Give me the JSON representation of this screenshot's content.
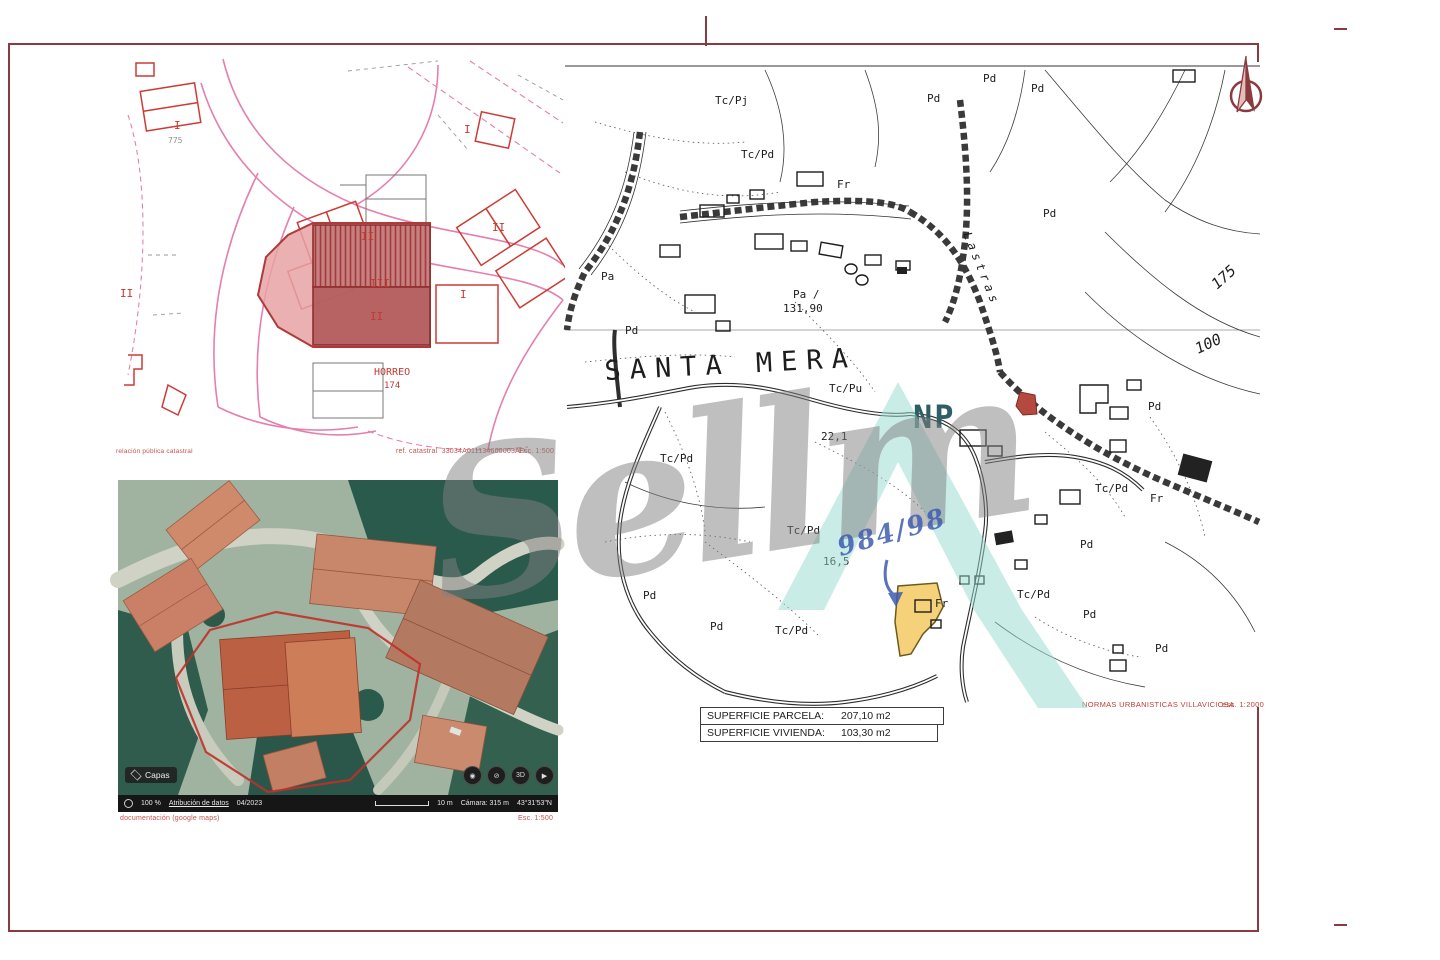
{
  "frame_color": "#8a3b42",
  "watermark": {
    "script_text": "Sellm"
  },
  "cadastral": {
    "caption_left": "relación pública catastral",
    "ref_label": "ref. catastral",
    "ref_value": "33034A011134600003AD",
    "scale": "Esc. 1:500",
    "labels": [
      {
        "t": "I",
        "x": 66,
        "y": 74
      },
      {
        "t": "775",
        "x": 60,
        "y": 88,
        "c": "#8f8f8f",
        "s": 8
      },
      {
        "t": "II",
        "x": 253,
        "y": 185
      },
      {
        "t": "III",
        "x": 262,
        "y": 232
      },
      {
        "t": "II",
        "x": 262,
        "y": 265
      },
      {
        "t": "I",
        "x": 352,
        "y": 243
      },
      {
        "t": "I",
        "x": 356,
        "y": 78
      },
      {
        "t": "II",
        "x": 384,
        "y": 176
      },
      {
        "t": "II",
        "x": 12,
        "y": 242
      },
      {
        "t": "HORREO",
        "x": 266,
        "y": 320,
        "s": 10
      },
      {
        "t": "174",
        "x": 276,
        "y": 333,
        "s": 9
      }
    ]
  },
  "aerial": {
    "layers_button_label": "Capas",
    "zoom_text": "100 %",
    "attribution_text": "Atribución de datos",
    "date_text": "04/2023",
    "scalebar_text": "10 m",
    "camera_text": "Cámara: 315 m",
    "coords_text": "43°31'53\"N",
    "caption_left": "documentación (google maps)",
    "caption_scale": "Esc. 1:500",
    "buttons": [
      {
        "name": "pegman",
        "glyph": "◉"
      },
      {
        "name": "compass",
        "glyph": "⊘"
      },
      {
        "name": "3d",
        "glyph": "3D"
      },
      {
        "name": "navigation",
        "glyph": "▶"
      }
    ]
  },
  "topo": {
    "handwriting": "984/98",
    "caption": "NORMAS URBANISTICAS VILLAVICIOSA",
    "scale": "esc. 1:2000",
    "labels": [
      {
        "t": "Pd",
        "x": 418,
        "y": 20
      },
      {
        "t": "Pd",
        "x": 466,
        "y": 30
      },
      {
        "t": "Pd",
        "x": 362,
        "y": 40
      },
      {
        "t": "Tc/Pj",
        "x": 150,
        "y": 42
      },
      {
        "t": "Tc/Pd",
        "x": 176,
        "y": 96
      },
      {
        "t": "Fr",
        "x": 272,
        "y": 126
      },
      {
        "t": "Pd",
        "x": 478,
        "y": 155
      },
      {
        "t": "Pa /",
        "x": 228,
        "y": 236
      },
      {
        "t": "131,90",
        "x": 218,
        "y": 250
      },
      {
        "t": "Pa",
        "x": 36,
        "y": 218
      },
      {
        "t": "Pd",
        "x": 60,
        "y": 272
      },
      {
        "t": "SANTA  MERA",
        "x": 40,
        "y": 318,
        "s": 27,
        "ls": 9,
        "r": -3
      },
      {
        "t": "Tc/Pu",
        "x": 264,
        "y": 330
      },
      {
        "t": "22,1",
        "x": 256,
        "y": 378
      },
      {
        "t": "NP",
        "x": 348,
        "y": 366,
        "s": 32,
        "b": true,
        "c": "#2e5f66",
        "ls": 2
      },
      {
        "t": "Tc/Pd",
        "x": 95,
        "y": 400
      },
      {
        "t": "Tc/Pd",
        "x": 222,
        "y": 472
      },
      {
        "t": "16,5",
        "x": 258,
        "y": 503
      },
      {
        "t": "Pd",
        "x": 78,
        "y": 537
      },
      {
        "t": "Pd",
        "x": 145,
        "y": 568
      },
      {
        "t": "Tc/Pd",
        "x": 210,
        "y": 572
      },
      {
        "t": "Fr",
        "x": 370,
        "y": 545
      },
      {
        "t": "Tc/Pd",
        "x": 452,
        "y": 536
      },
      {
        "t": "Pd",
        "x": 515,
        "y": 486
      },
      {
        "t": "Pd",
        "x": 518,
        "y": 556
      },
      {
        "t": "Pd",
        "x": 590,
        "y": 590
      },
      {
        "t": "Tc/Pd",
        "x": 530,
        "y": 430
      },
      {
        "t": "Fr",
        "x": 585,
        "y": 440
      },
      {
        "t": "Pd",
        "x": 583,
        "y": 348
      },
      {
        "t": "Lastras",
        "x": 398,
        "y": 172,
        "r": 68,
        "ls": 4,
        "s": 12,
        "i": true
      },
      {
        "t": "175",
        "x": 652,
        "y": 228,
        "r": -42,
        "s": 15,
        "i": true
      },
      {
        "t": "100",
        "x": 633,
        "y": 292,
        "r": -25,
        "s": 15,
        "i": true
      }
    ]
  },
  "table": {
    "rows": [
      {
        "label": "SUPERFICIE PARCELA:",
        "value": "207,10 m2"
      },
      {
        "label": "SUPERFICIE VIVIENDA:",
        "value": "103,30 m2"
      }
    ]
  }
}
